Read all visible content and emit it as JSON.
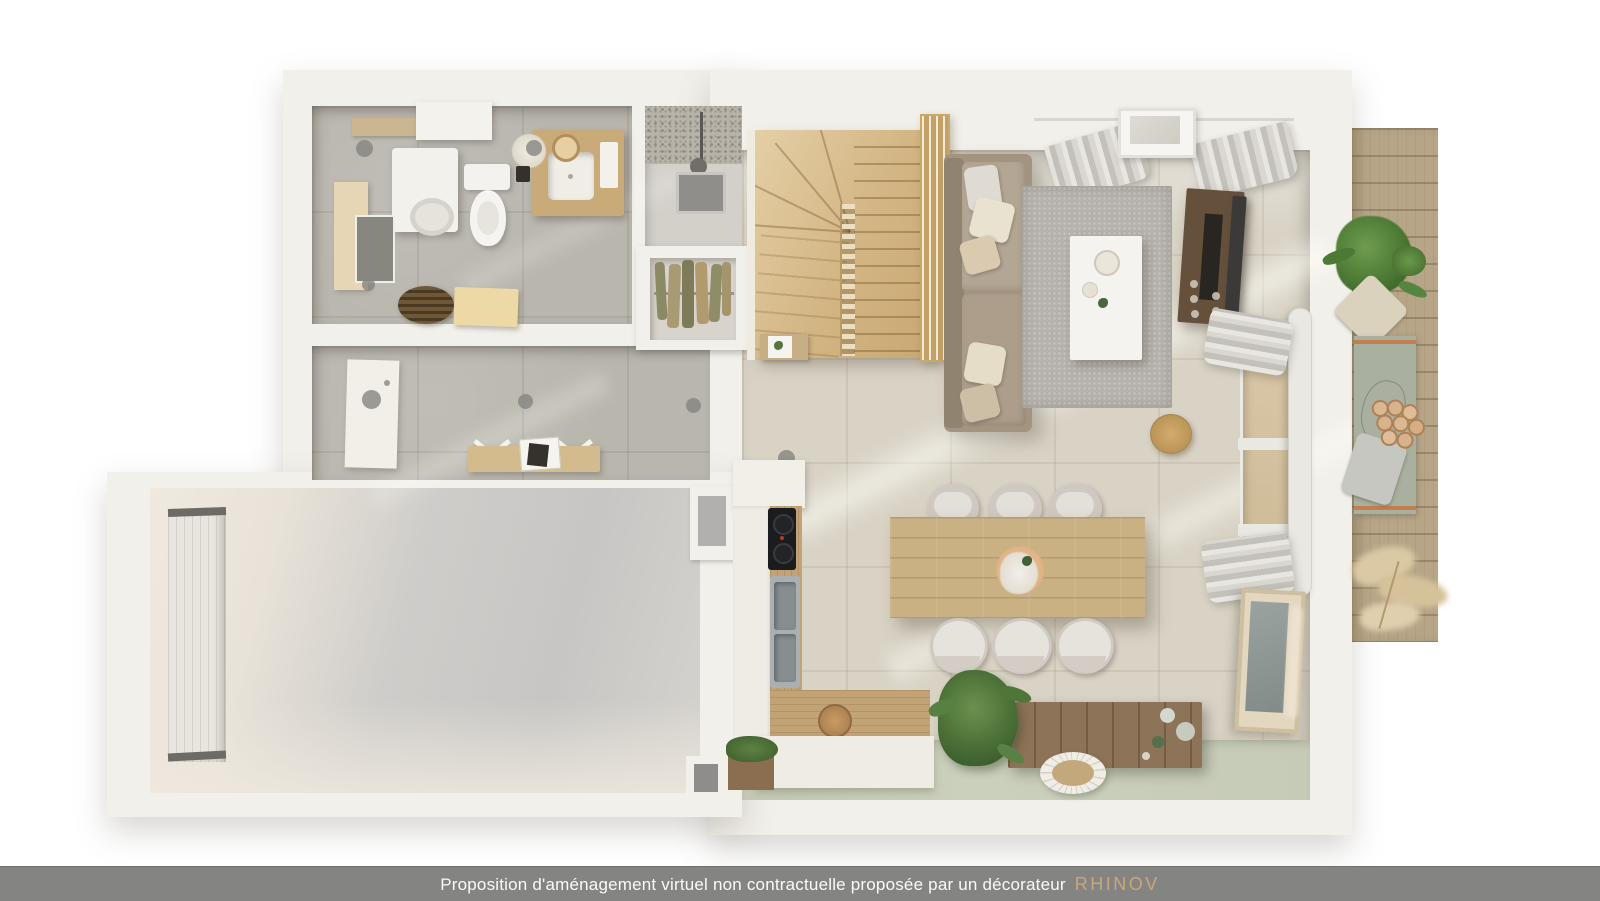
{
  "caption": {
    "text": "Proposition d'aménagement virtuel non contractuelle proposée par un décorateur",
    "brand": "RHINOV"
  },
  "colors": {
    "caption_bar": "#848482",
    "caption_text": "#fafafa",
    "brand_accent": "#c9a77a",
    "wall_white": "#f2f0ea",
    "tile_gray": "#b9b6ae",
    "tile_cream": "#d9d3c6",
    "floor_sage": "#c9ceba",
    "stairs_wood": "#d8c09a",
    "deck_wood": "#b6a587",
    "sofa_taupe": "#a2947f",
    "rug_gray": "#b5b1ab",
    "dining_table_oak": "#c9b184",
    "tv_stand_walnut": "#65503b",
    "bench_wood": "#8d7357",
    "kitchen_front": "#efece4",
    "cooktop_black": "#1b1c1e"
  },
  "scene": {
    "type": "floorplan-3d-top-view",
    "rooms": [
      "bathroom",
      "shower",
      "closet",
      "hallway",
      "garage",
      "staircase",
      "living-room",
      "dining-area",
      "kitchen",
      "balcony"
    ]
  }
}
